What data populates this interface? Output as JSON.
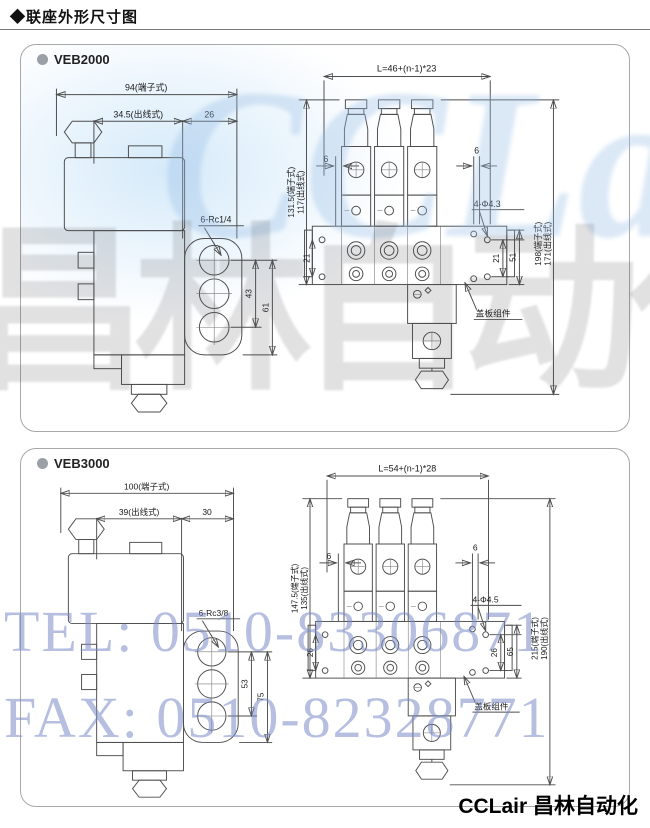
{
  "page": {
    "title": "◆联座外形尺寸图",
    "brand_footer": "CCLair 昌林自动化"
  },
  "watermark": {
    "logo": "CCLair",
    "brand_gray": "昌林自动化",
    "tel_line": "TEL: 0510-83306871",
    "fax_line": "FAX: 0510-82328771"
  },
  "veb2000": {
    "model": "VEB2000",
    "side": {
      "width_terminal": "94(端子式)",
      "width_cable": "34.5(出线式)",
      "width_right": "26",
      "ports": "6-Rc1/4",
      "h1": "43",
      "h2": "61"
    },
    "front": {
      "length": "L=46+(n-1)*23",
      "height_terminal": "131.5(端子式)",
      "height_cable": "117(出线式)",
      "pitch_left": "6",
      "pitch_right": "6",
      "hole_left": "21",
      "hole_mid": "21",
      "hole_right": "51",
      "holes": "4-Φ4.3",
      "plate": "盖板组件",
      "total_terminal": "198(端子式)",
      "total_cable": "171(出线式)"
    }
  },
  "veb3000": {
    "model": "VEB3000",
    "side": {
      "width_terminal": "100(端子式)",
      "width_cable": "39(出线式)",
      "width_right": "30",
      "ports": "6-Rc3/8",
      "h1": "53",
      "h2": "75"
    },
    "front": {
      "length": "L=54+(n-1)*28",
      "height_terminal": "147.5(端子式)",
      "height_cable": "135(出线式)",
      "pitch_left": "6",
      "pitch_right": "6",
      "hole_left": "26",
      "hole_mid": "26",
      "hole_right": "65",
      "holes": "4-Φ4.5",
      "plate": "盖板组件",
      "total_terminal": "215(端子式)",
      "total_cable": "190(出线式)"
    }
  }
}
